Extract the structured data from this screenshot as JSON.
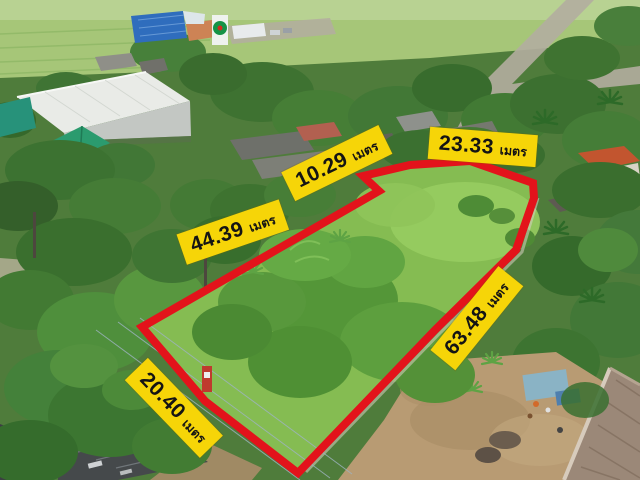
{
  "measurements": [
    {
      "value": "10.29",
      "unit": "เมตร"
    },
    {
      "value": "23.33",
      "unit": "เมตร"
    },
    {
      "value": "44.39",
      "unit": "เมตร"
    },
    {
      "value": "63.48",
      "unit": "เมตร"
    },
    {
      "value": "20.40",
      "unit": "เมตร"
    }
  ],
  "colors": {
    "boundary": "#e3131b",
    "label_bg": "#f6d508",
    "label_fg": "#141414"
  }
}
